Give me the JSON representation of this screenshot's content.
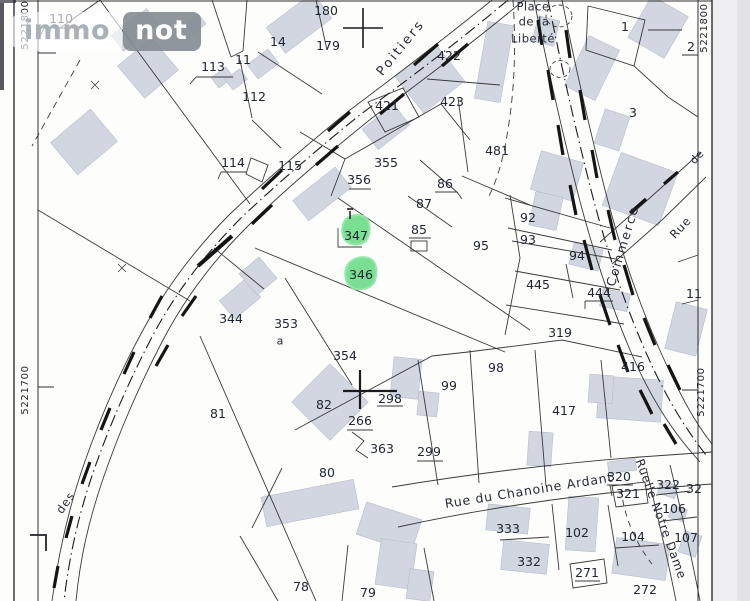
{
  "logo": {
    "part1": "immo",
    "part2": "not"
  },
  "map": {
    "highlight_color": "#6fdd8b",
    "building_color": "#d2d6e0",
    "highlighted_parcels": [
      "347",
      "346"
    ],
    "parcels": [
      {
        "label": "110",
        "x": 61,
        "y": 19
      },
      {
        "label": "113",
        "x": 213,
        "y": 67
      },
      {
        "label": "11",
        "x": 243,
        "y": 60
      },
      {
        "label": "14",
        "x": 278,
        "y": 42
      },
      {
        "label": "112",
        "x": 254,
        "y": 97
      },
      {
        "label": "180",
        "x": 326,
        "y": 11
      },
      {
        "label": "179",
        "x": 328,
        "y": 46
      },
      {
        "label": "422",
        "x": 449,
        "y": 56
      },
      {
        "label": "421",
        "x": 387,
        "y": 106
      },
      {
        "label": "423",
        "x": 452,
        "y": 102
      },
      {
        "label": "481",
        "x": 497,
        "y": 151
      },
      {
        "label": "1",
        "x": 625,
        "y": 27
      },
      {
        "label": "2",
        "x": 691,
        "y": 47
      },
      {
        "label": "3",
        "x": 633,
        "y": 113
      },
      {
        "label": "114",
        "x": 233,
        "y": 163
      },
      {
        "label": "115",
        "x": 290,
        "y": 166
      },
      {
        "label": "355",
        "x": 386,
        "y": 163
      },
      {
        "label": "356",
        "x": 359,
        "y": 180
      },
      {
        "label": "86",
        "x": 445,
        "y": 184
      },
      {
        "label": "87",
        "x": 424,
        "y": 204
      },
      {
        "label": "85",
        "x": 419,
        "y": 230
      },
      {
        "label": "95",
        "x": 481,
        "y": 246
      },
      {
        "label": "92",
        "x": 528,
        "y": 218
      },
      {
        "label": "93",
        "x": 528,
        "y": 240
      },
      {
        "label": "94",
        "x": 577,
        "y": 256
      },
      {
        "label": "445",
        "x": 538,
        "y": 285
      },
      {
        "label": "444",
        "x": 599,
        "y": 293
      },
      {
        "label": "319",
        "x": 560,
        "y": 333
      },
      {
        "label": "347",
        "x": 356,
        "y": 236
      },
      {
        "label": "346",
        "x": 361,
        "y": 275
      },
      {
        "label": "344",
        "x": 231,
        "y": 319
      },
      {
        "label": "353",
        "x": 286,
        "y": 324
      },
      {
        "label": "a",
        "x": 280,
        "y": 341,
        "fs": 11
      },
      {
        "label": "354",
        "x": 345,
        "y": 356
      },
      {
        "label": "81",
        "x": 218,
        "y": 414
      },
      {
        "label": "82",
        "x": 324,
        "y": 405
      },
      {
        "label": "298",
        "x": 390,
        "y": 399
      },
      {
        "label": "266",
        "x": 360,
        "y": 421
      },
      {
        "label": "363",
        "x": 382,
        "y": 449
      },
      {
        "label": "299",
        "x": 429,
        "y": 452
      },
      {
        "label": "98",
        "x": 496,
        "y": 368
      },
      {
        "label": "99",
        "x": 449,
        "y": 386
      },
      {
        "label": "416",
        "x": 633,
        "y": 367
      },
      {
        "label": "417",
        "x": 564,
        "y": 411
      },
      {
        "label": "80",
        "x": 327,
        "y": 473
      },
      {
        "label": "78",
        "x": 301,
        "y": 587
      },
      {
        "label": "79",
        "x": 368,
        "y": 593
      },
      {
        "label": "320",
        "x": 619,
        "y": 477
      },
      {
        "label": "321",
        "x": 628,
        "y": 494
      },
      {
        "label": "322",
        "x": 668,
        "y": 485
      },
      {
        "label": "106",
        "x": 674,
        "y": 509
      },
      {
        "label": "107",
        "x": 686,
        "y": 538
      },
      {
        "label": "102",
        "x": 577,
        "y": 533
      },
      {
        "label": "104",
        "x": 633,
        "y": 537
      },
      {
        "label": "271",
        "x": 587,
        "y": 573
      },
      {
        "label": "272",
        "x": 645,
        "y": 590
      },
      {
        "label": "333",
        "x": 508,
        "y": 529
      },
      {
        "label": "332",
        "x": 529,
        "y": 562
      },
      {
        "label": "11",
        "x": 694,
        "y": 294
      },
      {
        "label": "32",
        "x": 694,
        "y": 489
      }
    ],
    "streets": [
      {
        "label": "Poitiers",
        "x": 401,
        "y": 48,
        "rot": -51,
        "fs": 13,
        "ls": 2.5
      },
      {
        "label": "Place",
        "x": 533,
        "y": 7,
        "rot": 0,
        "fs": 11.5,
        "ls": 0.5
      },
      {
        "label": "de la",
        "x": 534,
        "y": 22,
        "rot": 0,
        "fs": 11.5,
        "ls": 0.5
      },
      {
        "label": "Liberté",
        "x": 533,
        "y": 39,
        "rot": 0,
        "fs": 11.5,
        "ls": 0.5
      },
      {
        "label": "Commerce",
        "x": 623,
        "y": 246,
        "rot": -73,
        "fs": 12.5,
        "ls": 2
      },
      {
        "label": "Rue",
        "x": 681,
        "y": 228,
        "rot": -47,
        "fs": 11.5,
        "ls": 1
      },
      {
        "label": "de",
        "x": 697,
        "y": 157,
        "rot": -47,
        "fs": 11,
        "ls": 0.5
      },
      {
        "label": "Rue du Chanoine Ardant",
        "x": 529,
        "y": 491,
        "rot": -9,
        "fs": 12.5,
        "ls": 0.8
      },
      {
        "label": "Ruelle Notre Dame",
        "x": 661,
        "y": 519,
        "rot": 70,
        "fs": 12,
        "ls": 0.8
      },
      {
        "label": "des",
        "x": 66,
        "y": 503,
        "rot": -55,
        "fs": 11.5,
        "ls": 1
      }
    ],
    "coordinates": [
      {
        "label": "5221800",
        "x": 26,
        "y": 25
      },
      {
        "label": "5221700",
        "x": 26,
        "y": 390
      },
      {
        "label": "5221800",
        "x": 705,
        "y": 28
      },
      {
        "label": "5221700",
        "x": 702,
        "y": 392
      }
    ]
  }
}
